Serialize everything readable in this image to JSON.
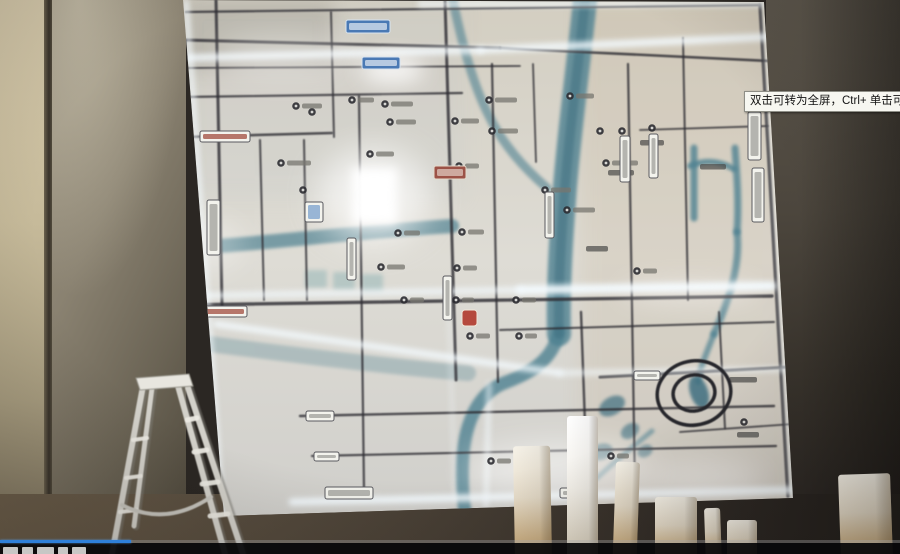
{
  "video_overlay": {
    "tooltip_text": "双击可转为全屏，Ctrl+ 单击可转为",
    "progress_fraction": 0.145,
    "progress_color": "#2f80d9"
  },
  "palette": {
    "map_base_top": "#d3cec1",
    "map_base_mid": "#dedcd5",
    "map_base_bottom": "#d0cfcb",
    "road_dark": "#2e2d33",
    "glow": "#f4fbff",
    "river": "#4e8191",
    "river_deep": "#3f6f80",
    "ladder_metal": "#d3d1ca",
    "post_light": "#f3eee3",
    "post_shade": "#c3a173",
    "sign_white": "#f3f3ed",
    "sign_blue": "#4a79b4",
    "sign_red": "#9c5247"
  },
  "map": {
    "panel_clip": "183,0 764,2 793,498 224,516",
    "roads_h": [
      [
        186,
        12,
        758,
        5,
        2.2
      ],
      [
        184,
        40,
        500,
        48,
        3
      ],
      [
        500,
        48,
        770,
        61,
        2.6
      ],
      [
        185,
        68,
        520,
        66,
        1.8
      ],
      [
        185,
        97,
        462,
        93,
        2.2
      ],
      [
        184,
        137,
        332,
        133,
        2.5
      ],
      [
        640,
        130,
        768,
        126,
        1.8
      ],
      [
        184,
        305,
        772,
        296,
        3.4
      ],
      [
        500,
        330,
        774,
        322,
        2
      ],
      [
        600,
        377,
        792,
        367,
        3
      ],
      [
        300,
        416,
        774,
        406,
        2.4
      ],
      [
        312,
        456,
        776,
        446,
        2.2
      ],
      [
        680,
        432,
        793,
        424,
        1.8
      ]
    ],
    "roads_v": [
      [
        216,
        0,
        222,
        305,
        3
      ],
      [
        260,
        140,
        264,
        300,
        2
      ],
      [
        304,
        140,
        307,
        300,
        2
      ],
      [
        331,
        12,
        334,
        137,
        2
      ],
      [
        359,
        96,
        364,
        490,
        2.2
      ],
      [
        445,
        0,
        456,
        380,
        3
      ],
      [
        492,
        64,
        498,
        382,
        2.2
      ],
      [
        533,
        64,
        536,
        162,
        1.8
      ],
      [
        581,
        312,
        588,
        508,
        2.4
      ],
      [
        628,
        64,
        635,
        490,
        2.2
      ],
      [
        683,
        38,
        688,
        300,
        2
      ],
      [
        760,
        5,
        788,
        496,
        3.4
      ],
      [
        719,
        312,
        725,
        428,
        2
      ]
    ],
    "glow_roads": [
      [
        186,
        58,
        480,
        50,
        7,
        0.85
      ],
      [
        480,
        50,
        768,
        37,
        7,
        0.9
      ],
      [
        184,
        296,
        520,
        290,
        6,
        0.75
      ],
      [
        520,
        290,
        772,
        286,
        9,
        0.95
      ],
      [
        292,
        502,
        792,
        490,
        7,
        0.95
      ],
      [
        186,
        2,
        222,
        512,
        5,
        0.8
      ],
      [
        420,
        4,
        764,
        4,
        5,
        0.85
      ],
      [
        764,
        6,
        792,
        497,
        4,
        0.55
      ],
      [
        216,
        324,
        560,
        373,
        6,
        0.9
      ],
      [
        560,
        373,
        790,
        369,
        5,
        0.7
      ],
      [
        489,
        384,
        486,
        506,
        4,
        0.8
      ],
      [
        449,
        310,
        455,
        500,
        3,
        0.45
      ]
    ],
    "glow_rects": [
      [
        352,
        168,
        45,
        56,
        5,
        1
      ]
    ],
    "glow_blobs": [
      [
        374,
        196,
        56,
        48,
        16,
        0.65
      ],
      [
        392,
        70,
        32,
        14,
        10,
        0.8
      ],
      [
        285,
        57,
        70,
        20,
        16,
        0.4
      ],
      [
        205,
        245,
        40,
        26,
        14,
        0.3
      ],
      [
        560,
        470,
        95,
        28,
        16,
        0.5
      ],
      [
        705,
        480,
        60,
        18,
        14,
        0.4
      ],
      [
        690,
        292,
        70,
        12,
        12,
        0.35
      ]
    ],
    "rivers": [
      [
        "M 585,0 C 578,70 568,140 564,200 C 560,252 558,300 559,334",
        24,
        0.8
      ],
      [
        "M 559,332 C 552,362 528,374 504,383 C 479,393 466,420 463,455 C 461,486 464,506 466,518",
        13,
        0.8
      ],
      [
        "M 452,-4 C 461,40 472,82 488,114 C 503,145 524,168 547,188",
        9,
        0.6
      ],
      [
        "M 218,246 C 285,241 370,231 452,226",
        14,
        0.7
      ],
      [
        "M 694,148 L 694,218",
        7,
        0.8
      ],
      [
        "M 690,166 C 706,159 720,161 734,169",
        6,
        0.8
      ],
      [
        "M 735,148 C 737,176 739,205 737,232",
        7,
        0.8
      ],
      [
        "M 737,232 C 741,266 728,302 714,334",
        7,
        0.75
      ],
      [
        "M 714,334 C 706,354 700,368 698,382",
        6,
        0.7
      ],
      [
        "M 597,478 C 615,461 634,446 652,431",
        5,
        0.6
      ],
      [
        "M 186,341 C 280,353 380,366 468,373",
        16,
        0.3
      ]
    ],
    "river_cores": [
      [
        "M 585,0 C 578,70 568,140 564,200 C 560,252 558,300 559,334",
        10,
        0.55
      ]
    ],
    "river_blobs": [
      [
        699,
        392,
        9,
        17,
        -18,
        0.85
      ],
      [
        612,
        406,
        14,
        9,
        -30,
        0.7
      ],
      [
        630,
        431,
        10,
        7,
        -35,
        0.65
      ],
      [
        645,
        451,
        8,
        6,
        -30,
        0.6
      ],
      [
        601,
        452,
        12,
        8,
        -20,
        0.6
      ]
    ],
    "spiral": {
      "cx": 694,
      "cy": 393,
      "outer_rx": 37,
      "outer_ry": 32,
      "inner_rx": 21,
      "inner_ry": 18,
      "rotate": -12,
      "stroke": "#26262b",
      "width": 3.5
    },
    "ghost_glyphs": [
      [
        305,
        270,
        22,
        18
      ],
      [
        333,
        272,
        22,
        18
      ],
      [
        361,
        274,
        22,
        18
      ]
    ],
    "pois": [
      [
        296,
        106,
        20
      ],
      [
        352,
        100,
        16
      ],
      [
        385,
        104,
        22
      ],
      [
        312,
        112,
        0
      ],
      [
        390,
        122,
        20
      ],
      [
        281,
        163,
        24
      ],
      [
        370,
        154,
        18
      ],
      [
        303,
        190,
        0
      ],
      [
        398,
        233,
        16
      ],
      [
        381,
        267,
        18
      ],
      [
        404,
        300,
        14
      ],
      [
        455,
        121,
        18
      ],
      [
        459,
        166,
        14
      ],
      [
        462,
        232,
        16
      ],
      [
        457,
        268,
        14
      ],
      [
        456,
        300,
        12
      ],
      [
        470,
        336,
        14
      ],
      [
        489,
        100,
        22
      ],
      [
        492,
        131,
        20
      ],
      [
        516,
        300,
        14
      ],
      [
        519,
        336,
        12
      ],
      [
        545,
        190,
        20
      ],
      [
        567,
        210,
        22
      ],
      [
        600,
        131,
        0
      ],
      [
        622,
        131,
        0
      ],
      [
        652,
        128,
        0
      ],
      [
        606,
        163,
        26
      ],
      [
        637,
        271,
        14
      ],
      [
        744,
        422,
        0
      ],
      [
        611,
        456,
        12
      ],
      [
        491,
        461,
        14
      ],
      [
        570,
        96,
        18
      ]
    ],
    "texts": [
      [
        700,
        164,
        26
      ],
      [
        729,
        377,
        28
      ],
      [
        737,
        432,
        22
      ],
      [
        586,
        246,
        22
      ],
      [
        640,
        140,
        24
      ],
      [
        608,
        170,
        26
      ]
    ],
    "signs": [
      {
        "x": 346,
        "y": 20,
        "w": 44,
        "h": 13,
        "t": "blue"
      },
      {
        "x": 362,
        "y": 57,
        "w": 38,
        "h": 12,
        "t": "blue"
      },
      {
        "x": 748,
        "y": 112,
        "w": 13,
        "h": 48,
        "t": "white",
        "v": true
      },
      {
        "x": 752,
        "y": 168,
        "w": 12,
        "h": 54,
        "t": "white",
        "v": true
      },
      {
        "x": 207,
        "y": 200,
        "w": 13,
        "h": 55,
        "t": "white",
        "v": true
      },
      {
        "x": 196,
        "y": 318,
        "w": 11,
        "h": 52,
        "t": "white",
        "v": true
      },
      {
        "x": 200,
        "y": 131,
        "w": 50,
        "h": 11,
        "t": "redline"
      },
      {
        "x": 189,
        "y": 306,
        "w": 58,
        "h": 11,
        "t": "redline"
      },
      {
        "x": 434,
        "y": 166,
        "w": 32,
        "h": 13,
        "t": "red"
      },
      {
        "x": 462,
        "y": 310,
        "w": 15,
        "h": 16,
        "t": "redblob"
      },
      {
        "x": 306,
        "y": 411,
        "w": 28,
        "h": 10,
        "t": "white"
      },
      {
        "x": 314,
        "y": 452,
        "w": 25,
        "h": 9,
        "t": "white"
      },
      {
        "x": 325,
        "y": 487,
        "w": 48,
        "h": 12,
        "t": "white"
      },
      {
        "x": 560,
        "y": 488,
        "w": 36,
        "h": 10,
        "t": "white"
      },
      {
        "x": 634,
        "y": 371,
        "w": 26,
        "h": 9,
        "t": "white"
      },
      {
        "x": 620,
        "y": 136,
        "w": 10,
        "h": 46,
        "t": "white",
        "v": true
      },
      {
        "x": 649,
        "y": 134,
        "w": 9,
        "h": 44,
        "t": "white",
        "v": true
      },
      {
        "x": 545,
        "y": 192,
        "w": 9,
        "h": 46,
        "t": "white",
        "v": true
      },
      {
        "x": 347,
        "y": 238,
        "w": 9,
        "h": 42,
        "t": "white",
        "v": true
      },
      {
        "x": 443,
        "y": 276,
        "w": 9,
        "h": 44,
        "t": "white",
        "v": true
      },
      {
        "x": 305,
        "y": 202,
        "w": 18,
        "h": 20,
        "t": "card"
      }
    ]
  },
  "foreground": {
    "ladder": {
      "rails": [
        [
          143,
          386,
          112,
          554,
          6
        ],
        [
          152,
          388,
          134,
          526,
          5
        ],
        [
          178,
          386,
          225,
          554,
          6
        ],
        [
          188,
          388,
          243,
          554,
          6
        ]
      ],
      "cap": "136,378 189,374 193,386 140,390",
      "steps": [
        [
          187,
          420,
          197,
          418,
          5
        ],
        [
          194,
          452,
          207,
          450,
          5
        ],
        [
          202,
          484,
          218,
          482,
          5
        ],
        [
          210,
          516,
          228,
          514,
          5
        ],
        [
          133,
          440,
          147,
          438,
          4
        ],
        [
          126,
          478,
          141,
          476,
          4
        ],
        [
          120,
          512,
          137,
          510,
          4
        ]
      ],
      "spreader": "M 122,505 Q 166,527 211,497"
    },
    "posts": [
      {
        "x": 513,
        "w": 37,
        "top": 446,
        "lean": -1
      },
      {
        "x": 567,
        "w": 31,
        "top": 416,
        "lean": 0,
        "bright": true
      },
      {
        "x": 616,
        "w": 24,
        "top": 462,
        "lean": 2
      },
      {
        "x": 655,
        "w": 42,
        "top": 497,
        "lean": 0
      },
      {
        "x": 704,
        "w": 16,
        "top": 508,
        "lean": -2
      },
      {
        "x": 727,
        "w": 30,
        "top": 520,
        "lean": 0
      },
      {
        "x": 838,
        "w": 52,
        "top": 474,
        "lean": -2
      }
    ]
  }
}
